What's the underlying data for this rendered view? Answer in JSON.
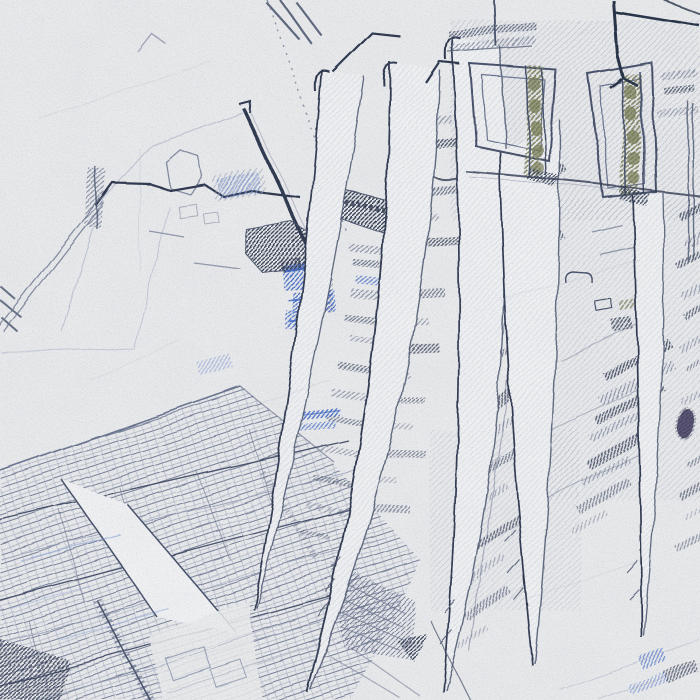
{
  "artwork": {
    "description": "Pencil and ink sketch on textured paper: aerial view of an industrial sci-fi cityscape crossed by a fan of pale tapering blades; hatched detail bands, two arch-frame structures with olive accents at top right, dense street grid at bottom left, bright blue accent patches near center left",
    "style": "graphite-sketch",
    "elements": {
      "beams": "five pale tapering blades fanning from bottom tips upward",
      "arches": "two tall rectangular arch frames with olive hatched columns",
      "grid": "dense diagonal street/track grid in lower left",
      "accents": "cobalt blue patches, olive columns, small violet blob at right edge"
    }
  },
  "palette": {
    "paper": "#e8e9eb",
    "paper_bright": "#eff0f2",
    "ink_dark": "#2e3850",
    "ink": "#46516b",
    "ink_med": "#6b7590",
    "ink_light": "#9aa3b8",
    "ink_faint": "#bcc3d2",
    "accent_blue": "#3f68c5",
    "accent_blue_light": "#7e9bd8",
    "accent_olive": "#757a52",
    "accent_purple": "#443a60",
    "navy": "#263247"
  }
}
